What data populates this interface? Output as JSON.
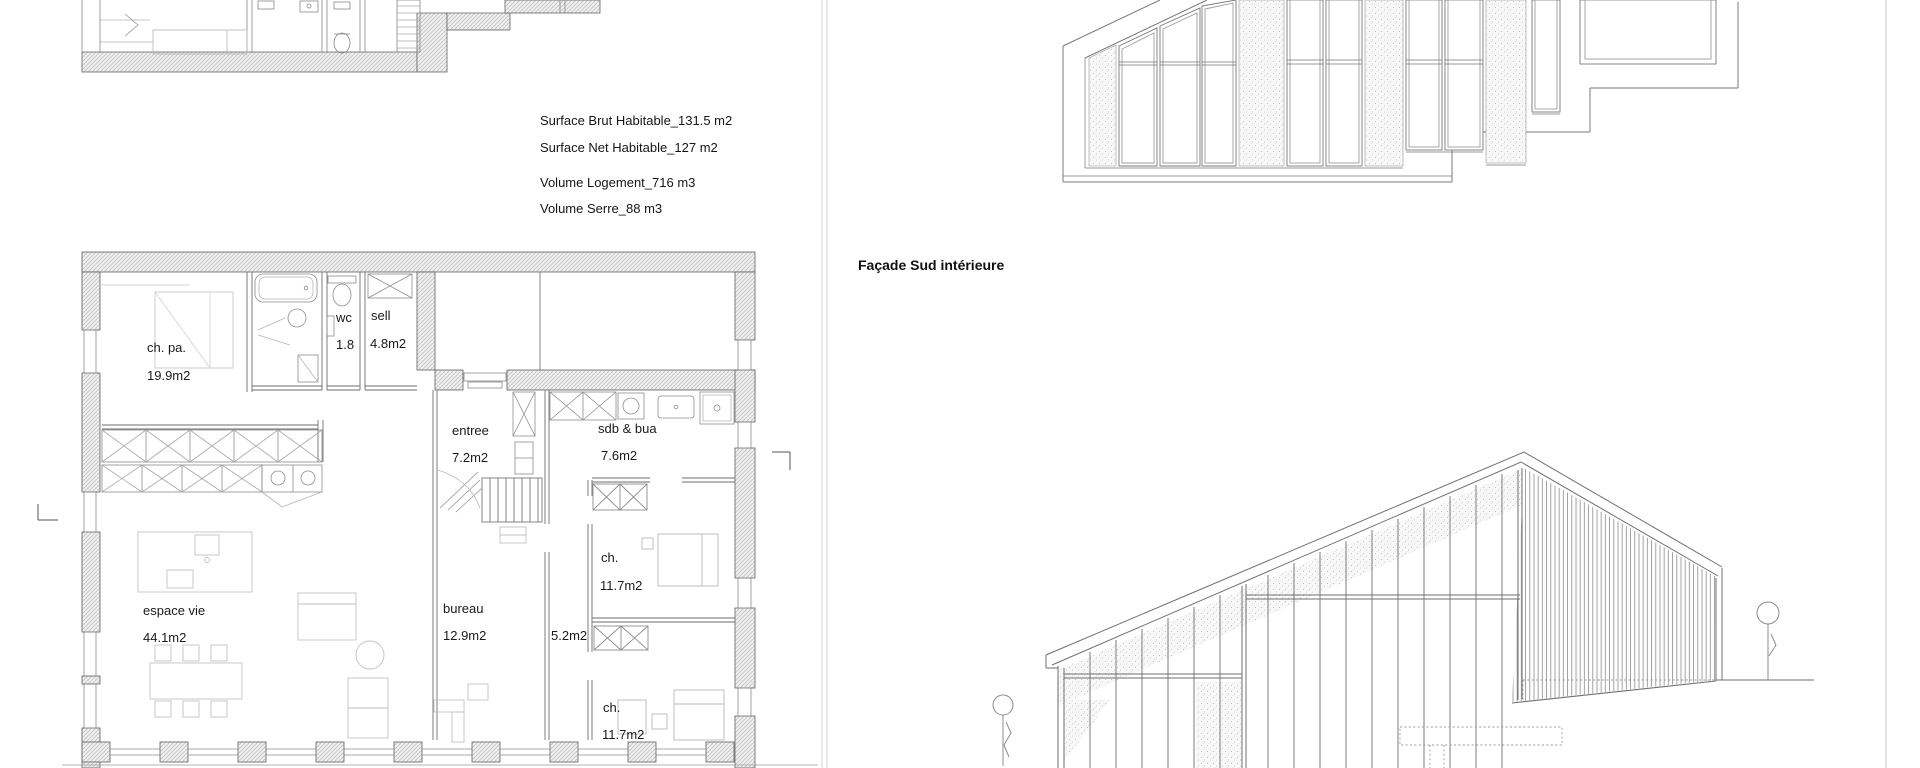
{
  "stats": {
    "line1": "Surface Brut Habitable_131.5 m2",
    "line2": "Surface Net Habitable_127 m2",
    "line3": "Volume Logement_716 m3",
    "line4": "Volume Serre_88 m3"
  },
  "elevation": {
    "title": "Façade Sud intérieure"
  },
  "rooms": {
    "ch_pa": {
      "name": "ch. pa.",
      "area": "19.9m2"
    },
    "wc": {
      "name": "wc",
      "area": "1.8"
    },
    "sell": {
      "name": "sell",
      "area": "4.8m2"
    },
    "entree": {
      "name": "entree",
      "area": "7.2m2"
    },
    "sdb": {
      "name": "sdb & bua",
      "area": "7.6m2"
    },
    "espace_vie": {
      "name": "espace vie",
      "area": "44.1m2"
    },
    "bureau": {
      "name": "bureau",
      "area": "12.9m2"
    },
    "couloir": {
      "area": "5.2m2"
    },
    "ch1": {
      "name": "ch.",
      "area": "11.7m2"
    },
    "ch2": {
      "name": "ch.",
      "area": "11.7m2"
    }
  },
  "colors": {
    "line": "#6b6b6b",
    "wall_hatch": "#b0b0b0",
    "text": "#1a1a1a"
  }
}
